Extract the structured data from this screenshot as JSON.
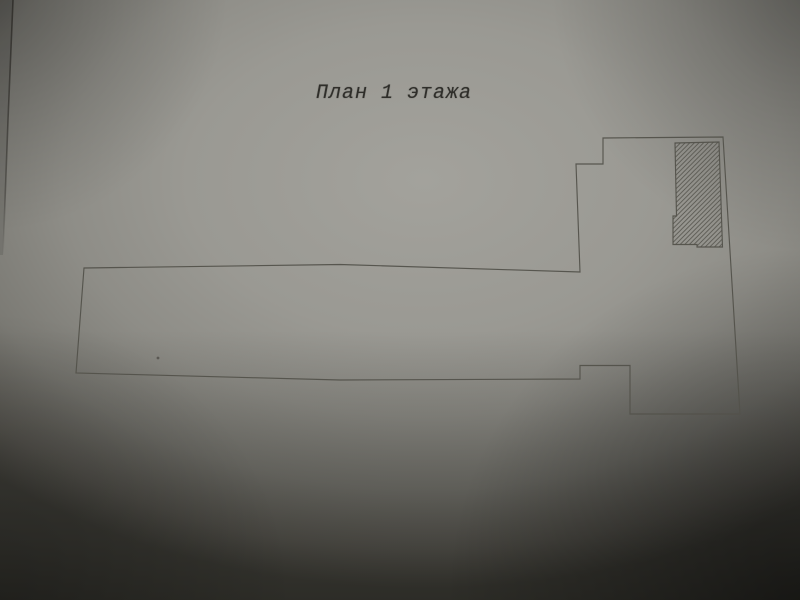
{
  "document": {
    "title": "План 1 этажа"
  },
  "colors": {
    "paper_center": "#a3a29c",
    "paper_shadowed_edge": "#4b4a44",
    "line": "#53524b",
    "hatch_line": "#56554e",
    "title_text": "#2f2e2a"
  },
  "plan": {
    "outline_points": "603,138 723,137 740,414 630,414 630,365.5 580,365.5 580,379 340,380 76,373 84,268 340,264.5 580,272 576,164 603,164",
    "hatch_points": "675,143 719,142 722.5,247 697,247 697,244.5 673,244.5 673,216 676.5,216",
    "paper_edge_points": "13,0 8,120 3,255",
    "speck": {
      "cx": "158",
      "cy": "358"
    }
  }
}
